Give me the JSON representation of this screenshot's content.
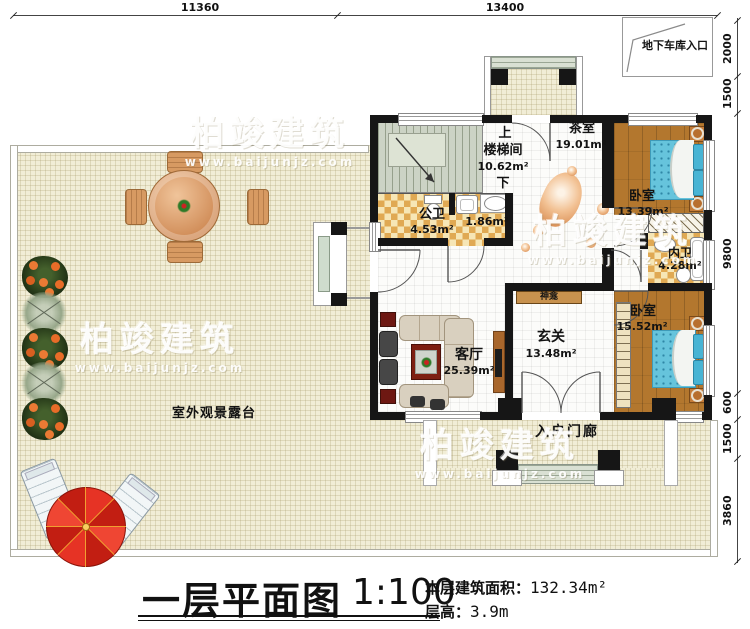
{
  "dimensions": {
    "top": [
      "11360",
      "13400"
    ],
    "right": [
      "2000",
      "1500",
      "9800",
      "600",
      "1500",
      "3860"
    ]
  },
  "garage": {
    "label": "地下车库入口"
  },
  "rooms": {
    "stairwell": {
      "name": "楼梯间",
      "area": "10.62m²",
      "up": "上",
      "down": "下"
    },
    "tea_room": {
      "name": "茶室",
      "area": "19.01m²"
    },
    "public_bath": {
      "name": "公卫",
      "area": "4.53m²"
    },
    "small_bath": {
      "area": "1.86m²"
    },
    "bedroom1": {
      "name": "卧室",
      "area": "13.39m²"
    },
    "inner_bath": {
      "name": "内卫",
      "area": "4.28m²"
    },
    "bedroom2": {
      "name": "卧室",
      "area": "15.52m²"
    },
    "living": {
      "name": "客厅",
      "area": "25.39m²"
    },
    "foyer": {
      "name": "玄关",
      "area": "13.48m²"
    },
    "shrine": {
      "name": "神龛"
    },
    "porch": {
      "name": "入户门廊"
    },
    "terrace": {
      "name": "室外观景露台"
    }
  },
  "titleblock": {
    "title": "一层平面图",
    "scale": "1:100",
    "area_label": "本层建筑面积：",
    "area_value": "132.34m²",
    "height_label": "层高：",
    "height_value": "3.9m"
  },
  "watermark": {
    "text": "柏竣建筑",
    "url": "www.baijunjz.com"
  }
}
